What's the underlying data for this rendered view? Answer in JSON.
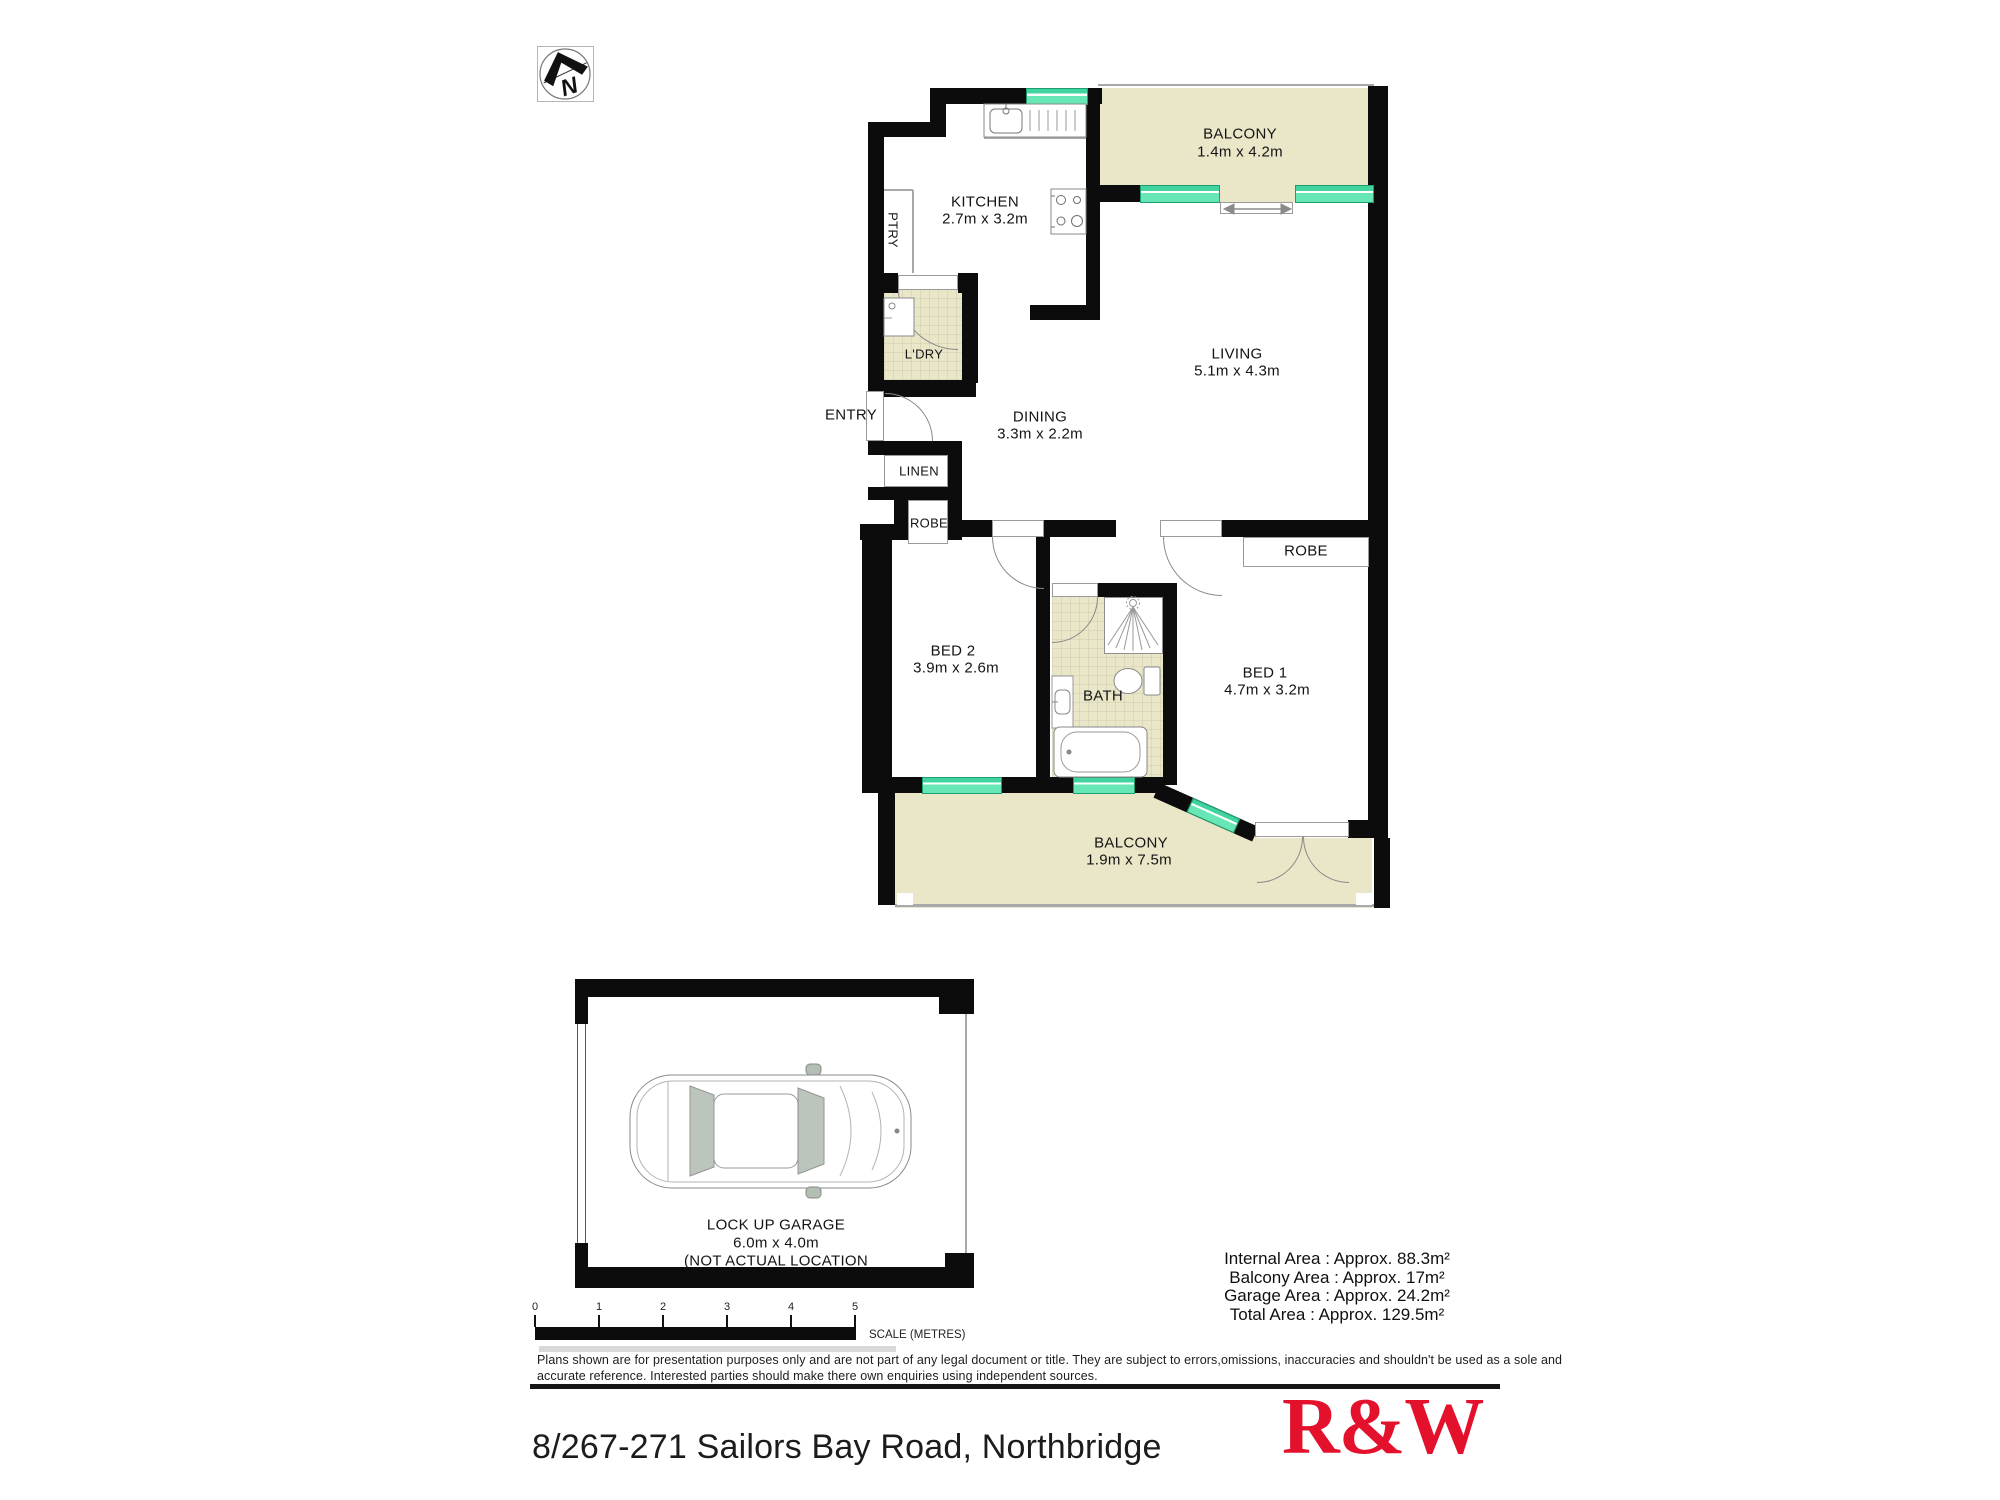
{
  "plan": {
    "north_letter": "N",
    "rooms": {
      "balcony_top": {
        "name": "BALCONY",
        "dims": "1.4m x 4.2m"
      },
      "kitchen": {
        "name": "KITCHEN",
        "dims": "2.7m x 3.2m"
      },
      "pantry": {
        "name": "PTRY"
      },
      "laundry": {
        "name": "L'DRY"
      },
      "entry": {
        "name": "ENTRY"
      },
      "dining": {
        "name": "DINING",
        "dims": "3.3m x 2.2m"
      },
      "living": {
        "name": "LIVING",
        "dims": "5.1m x 4.3m"
      },
      "linen": {
        "name": "LINEN"
      },
      "robe_bed2": {
        "name": "ROBE"
      },
      "robe_bed1": {
        "name": "ROBE"
      },
      "bed2": {
        "name": "BED 2",
        "dims": "3.9m x 2.6m"
      },
      "bath": {
        "name": "BATH"
      },
      "bed1": {
        "name": "BED 1",
        "dims": "4.7m x 3.2m"
      },
      "balcony_bottom": {
        "name": "BALCONY",
        "dims": "1.9m x 7.5m"
      },
      "garage": {
        "name": "LOCK UP GARAGE",
        "dims": "6.0m x 4.0m",
        "note": "(NOT ACTUAL LOCATION"
      }
    }
  },
  "scale_bar": {
    "ticks": [
      "0",
      "1",
      "2",
      "3",
      "4",
      "5"
    ],
    "label": "SCALE (METRES)"
  },
  "areas": {
    "internal": "Internal Area : Approx. 88.3m²",
    "balcony": "Balcony Area : Approx. 17m²",
    "garage": "Garage Area : Approx. 24.2m²",
    "total": "Total Area : Approx. 129.5m²"
  },
  "disclaimer": {
    "line1": "Plans shown are for presentation purposes only and are not part of any legal document or title. They are subject to errors,omissions, inaccuracies and shouldn't be used as a sole and",
    "line2": "accurate reference. Interested parties should make there own enquiries using independent sources."
  },
  "footer": {
    "address": "8/267-271 Sailors Bay Road, Northbridge",
    "logo": "R&W"
  },
  "colors": {
    "brand_red": "#e4112d",
    "window_green": "#5fe3ae",
    "floor_beige": "#eae6c8",
    "wall_black": "#0c0c0c"
  }
}
